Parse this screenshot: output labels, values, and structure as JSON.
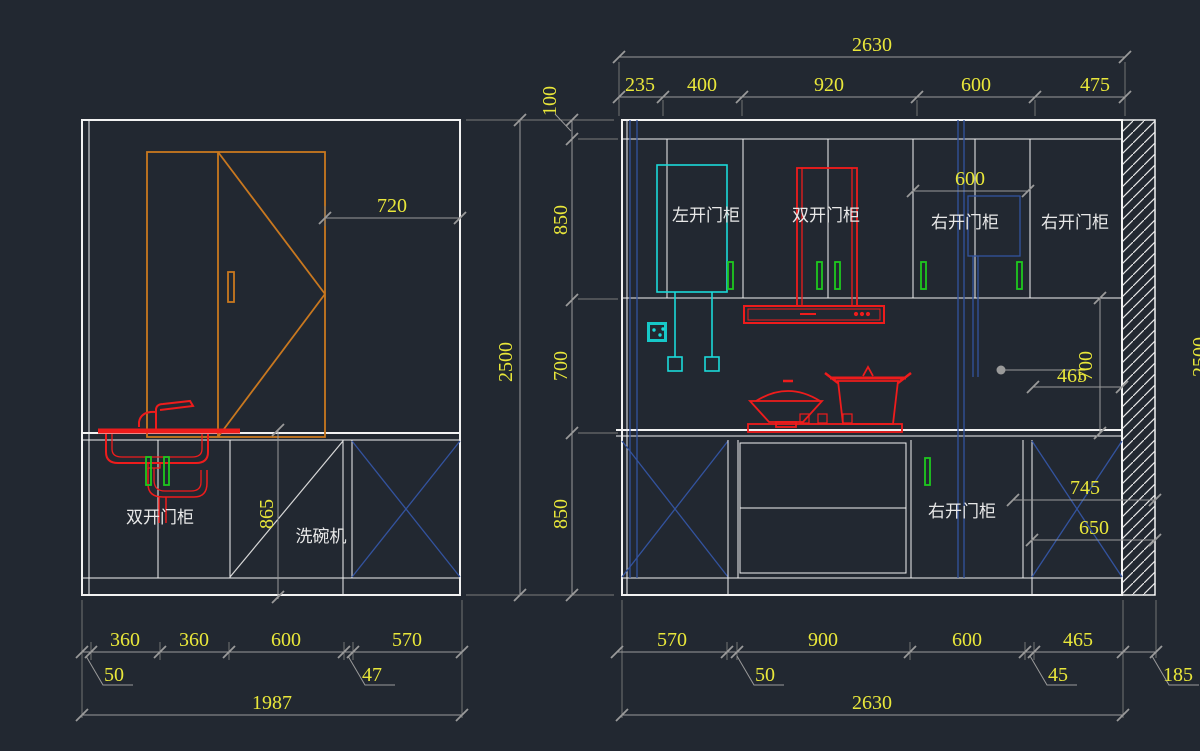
{
  "drawing": {
    "background": "#222831",
    "colors": {
      "dim_text": "#e9e73a",
      "lines": "#f2f2f2",
      "dim_lines": "#9a9a9a",
      "cabinet_orange": "#c9781f",
      "fixture_red": "#ee1c1c",
      "fixture_cyan": "#1bd9d9",
      "handle_green": "#1ec81e",
      "aux_blue": "#33539f"
    },
    "left_elevation": {
      "dim_width_720": "720",
      "dim_counter_height_865": "865",
      "label_sink_cabinet": "双开门柜",
      "label_dishwasher": "洗碗机",
      "bottom_dims": [
        "360",
        "360",
        "600",
        "570"
      ],
      "leader_50": "50",
      "leader_47": "47",
      "dim_overall": "1987"
    },
    "shared_vertical_dims": {
      "overall_height": "2500",
      "soffit": "100",
      "upper_cabinet": "850",
      "backsplash": "700",
      "base_cabinet": "850"
    },
    "right_elevation": {
      "dim_top_overall": "2630",
      "top_dims": [
        "235",
        "400",
        "920",
        "600",
        "475"
      ],
      "label_left_door_cabinet": "左开门柜",
      "label_double_door_cabinet": "双开门柜",
      "label_right_door_cabinet_1": "右开门柜",
      "label_right_door_cabinet_2": "右开门柜",
      "label_right_door_base_cabinet": "右开门柜",
      "dim_600": "600",
      "dim_465": "465",
      "dim_700": "700",
      "dim_745": "745",
      "dim_650": "650",
      "bottom_dims": [
        "570",
        "900",
        "600",
        "465"
      ],
      "leader_50": "50",
      "leader_45": "45",
      "leader_185": "185",
      "dim_bottom_overall": "2630",
      "dim_right_height": "2500"
    }
  }
}
